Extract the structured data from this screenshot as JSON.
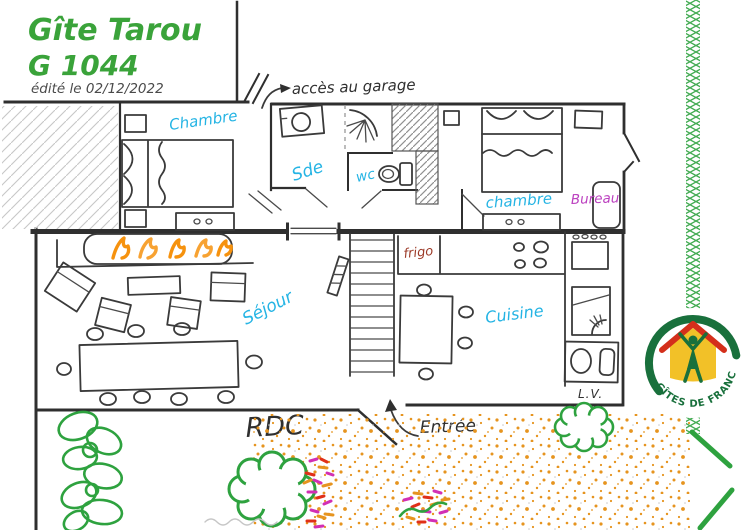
{
  "header": {
    "title_line1": "Gîte Tarou",
    "title_line2": "G 1044",
    "edited_note": "édité le 02/12/2022"
  },
  "plan": {
    "garage_access_label": "accès au garage",
    "floor_label": "RDC",
    "entrance_label": "Entrée",
    "rooms": {
      "bedroom_left": "Chambre",
      "shower_room": "Sde",
      "toilet": "wc",
      "bedroom_right": "chambre",
      "office": "Bureau",
      "living_room": "Séjour",
      "kitchen": "Cuisine"
    },
    "items": {
      "fridge": "frigo",
      "dishwasher": "L.V."
    }
  },
  "logo": {
    "text": "GÎTES DE FRANCE"
  },
  "colors": {
    "title_green": "#3aa33a",
    "label_cyan": "#25b4e4",
    "office_purple": "#bb3fbf",
    "fridge_red": "#9c3a28",
    "ink": "#2f2f2f",
    "flame_orange": "#f6920e",
    "gravel_orange": "#e6941f",
    "plant_green": "#2ea23f",
    "flower_magenta": "#d22fb4",
    "flower_red": "#e03018",
    "logo_green": "#19703c",
    "logo_yellow": "#f2c128",
    "logo_red": "#d42f1b"
  }
}
